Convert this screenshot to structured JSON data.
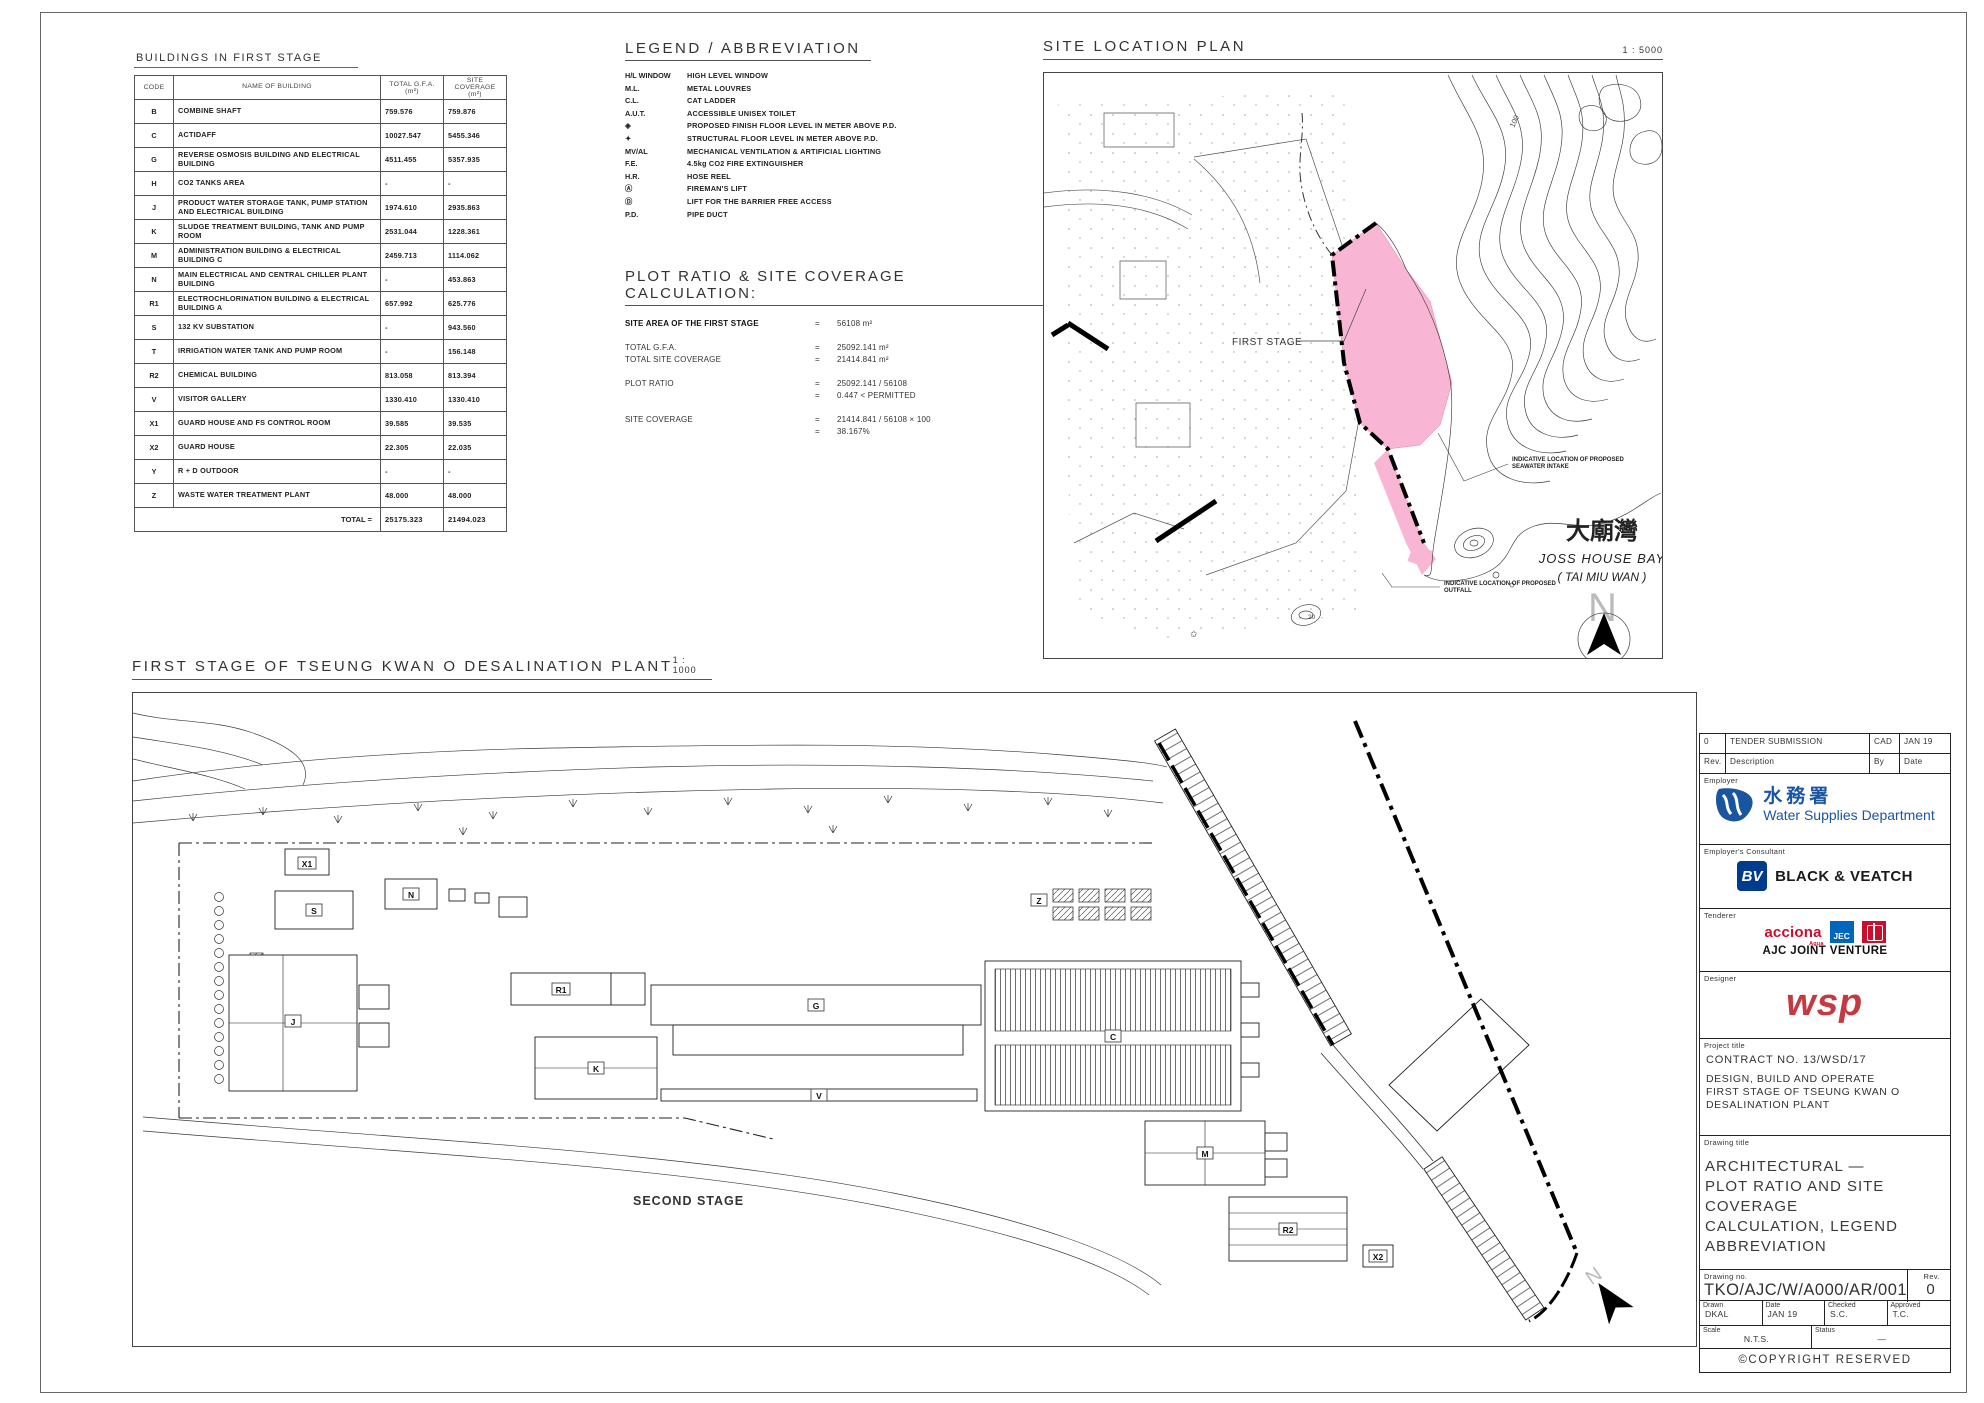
{
  "colors": {
    "pink": "#F8B6D4",
    "wsd_blue": "#1A56A0",
    "bv_navy": "#003B8E",
    "acciona_red": "#C8102E",
    "jec_blue": "#0065BD",
    "cscec_red": "#C8102E",
    "wsp_red": "#C43A42"
  },
  "buildings_table": {
    "title": "BUILDINGS IN FIRST STAGE",
    "headers": [
      "CODE",
      "NAME OF BUILDING",
      "TOTAL G.F.A. (m²)",
      "SITE COVERAGE (m²)"
    ],
    "rows": [
      {
        "code": "B",
        "name": "COMBINE SHAFT",
        "gfa": "759.576",
        "cov": "759.876"
      },
      {
        "code": "C",
        "name": "ACTIDAFF",
        "gfa": "10027.547",
        "cov": "5455.346"
      },
      {
        "code": "G",
        "name": "REVERSE OSMOSIS BUILDING AND ELECTRICAL BUILDING",
        "gfa": "4511.455",
        "cov": "5357.935"
      },
      {
        "code": "H",
        "name": "CO2 TANKS AREA",
        "gfa": "-",
        "cov": "-"
      },
      {
        "code": "J",
        "name": "PRODUCT WATER STORAGE TANK, PUMP STATION AND ELECTRICAL BUILDING",
        "gfa": "1974.610",
        "cov": "2935.863"
      },
      {
        "code": "K",
        "name": "SLUDGE TREATMENT BUILDING, TANK AND PUMP ROOM",
        "gfa": "2531.044",
        "cov": "1228.361"
      },
      {
        "code": "M",
        "name": "ADMINISTRATION BUILDING & ELECTRICAL BUILDING C",
        "gfa": "2459.713",
        "cov": "1114.062"
      },
      {
        "code": "N",
        "name": "MAIN ELECTRICAL AND CENTRAL CHILLER PLANT BUILDING",
        "gfa": "-",
        "cov": "453.863"
      },
      {
        "code": "R1",
        "name": "ELECTROCHLORINATION BUILDING & ELECTRICAL BUILDING A",
        "gfa": "657.992",
        "cov": "625.776"
      },
      {
        "code": "S",
        "name": "132 KV SUBSTATION",
        "gfa": "-",
        "cov": "943.560"
      },
      {
        "code": "T",
        "name": "IRRIGATION WATER TANK AND PUMP ROOM",
        "gfa": "-",
        "cov": "156.148"
      },
      {
        "code": "R2",
        "name": "CHEMICAL BUILDING",
        "gfa": "813.058",
        "cov": "813.394"
      },
      {
        "code": "V",
        "name": "VISITOR GALLERY",
        "gfa": "1330.410",
        "cov": "1330.410"
      },
      {
        "code": "X1",
        "name": "GUARD HOUSE AND FS CONTROL ROOM",
        "gfa": "39.585",
        "cov": "39.535"
      },
      {
        "code": "X2",
        "name": "GUARD HOUSE",
        "gfa": "22.305",
        "cov": "22.035"
      },
      {
        "code": "Y",
        "name": "R + D OUTDOOR",
        "gfa": "-",
        "cov": "-"
      },
      {
        "code": "Z",
        "name": "WASTE WATER TREATMENT PLANT",
        "gfa": "48.000",
        "cov": "48.000"
      }
    ],
    "total_label": "TOTAL =",
    "total_gfa": "25175.323",
    "total_cov": "21494.023"
  },
  "legend": {
    "title": "LEGEND / ABBREVIATION",
    "items": [
      {
        "abbr": "H/L WINDOW",
        "desc": "HIGH LEVEL WINDOW"
      },
      {
        "abbr": "M.L.",
        "desc": "METAL LOUVRES"
      },
      {
        "abbr": "C.L.",
        "desc": "CAT LADDER"
      },
      {
        "abbr": "A.U.T.",
        "desc": "ACCESSIBLE UNISEX TOILET"
      },
      {
        "abbr": "◈",
        "desc": "PROPOSED FINISH FLOOR LEVEL IN METER ABOVE P.D."
      },
      {
        "abbr": "✦",
        "desc": "STRUCTURAL FLOOR LEVEL IN METER ABOVE P.D."
      },
      {
        "abbr": "MV/AL",
        "desc": "MECHANICAL VENTILATION & ARTIFICIAL LIGHTING"
      },
      {
        "abbr": "F.E.",
        "desc": "4.5kg CO2 FIRE EXTINGUISHER"
      },
      {
        "abbr": "H.R.",
        "desc": "HOSE REEL"
      },
      {
        "abbr": "Ⓐ",
        "desc": "FIREMAN'S LIFT"
      },
      {
        "abbr": "Ⓓ",
        "desc": "LIFT FOR THE BARRIER FREE ACCESS"
      },
      {
        "abbr": "P.D.",
        "desc": "PIPE DUCT"
      }
    ]
  },
  "calc": {
    "title": "PLOT RATIO & SITE COVERAGE CALCULATION:",
    "lines": [
      {
        "label": "SITE AREA OF THE FIRST STAGE",
        "eq": "=",
        "value": "56108 m²"
      },
      {
        "label": "TOTAL G.F.A.",
        "eq": "=",
        "value": "25092.141 m²"
      },
      {
        "label": "TOTAL SITE COVERAGE",
        "eq": "=",
        "value": "21414.841 m²"
      },
      {
        "label": "PLOT RATIO",
        "eq": "=",
        "value": "25092.141 / 56108"
      },
      {
        "label": "",
        "eq": "=",
        "value": "0.447  <  PERMITTED"
      },
      {
        "label": "SITE COVERAGE",
        "eq": "=",
        "value": "21414.841 / 56108  ×  100"
      },
      {
        "label": "",
        "eq": "=",
        "value": "38.167%"
      }
    ]
  },
  "location_plan": {
    "title": "SITE LOCATION PLAN",
    "scale": "1 : 5000",
    "first_stage": "FIRST STAGE",
    "contour_100": "100",
    "contour_20": "20",
    "bay_cn": "大廟灣",
    "bay_en": "JOSS HOUSE BAY",
    "bay_en2": "( TAI MIU WAN )",
    "note_intake_1": "INDICATIVE LOCATION OF PROPOSED",
    "note_intake_2": "SEAWATER INTAKE",
    "note_outfall_1": "INDICATIVE LOCATION OF PROPOSED",
    "note_outfall_2": "OUTFALL",
    "north": "N"
  },
  "site_plan": {
    "title": "FIRST STAGE OF TSEUNG KWAN O DESALINATION PLANT",
    "scale": "1 : 1000",
    "second_stage": "SECOND STAGE",
    "north": "N",
    "labels": {
      "x1": "X1",
      "s": "S",
      "n": "N",
      "r1": "R1",
      "j": "J",
      "k": "K",
      "g": "G",
      "v": "V",
      "c": "C",
      "z": "Z",
      "m": "M",
      "r2": "R2",
      "x2": "X2"
    }
  },
  "title_block": {
    "revision": {
      "rev": "0",
      "description": "TENDER SUBMISSION",
      "by": "CAD",
      "date": "JAN 19"
    },
    "rev_headers": {
      "rev": "Rev.",
      "description": "Description",
      "by": "By",
      "date": "Date"
    },
    "employer_label": "Employer",
    "employer_cn": "水務署",
    "employer_en": "Water Supplies Department",
    "consultant_label": "Employer's Consultant",
    "consultant_logo": "BV",
    "consultant_name": "BLACK & VEATCH",
    "tenderer_label": "Tenderer",
    "acciona": "acciona",
    "acciona_sub": "Agua",
    "jec": "JEC",
    "tenderer_name": "AJC JOINT VENTURE",
    "designer_label": "Designer",
    "designer_name": "wsp",
    "project_label": "Project title",
    "project_line1": "CONTRACT NO. 13/WSD/17",
    "project_line2": "DESIGN, BUILD AND OPERATE",
    "project_line3": "FIRST STAGE OF TSEUNG KWAN O",
    "project_line4": "DESALINATION PLANT",
    "drawing_label": "Drawing title",
    "drawing_line1": "ARCHITECTURAL —",
    "drawing_line2": "PLOT RATIO AND SITE COVERAGE",
    "drawing_line3": "CALCULATION, LEGEND",
    "drawing_line4": "ABBREVIATION",
    "drawing_no_label": "Drawing no.",
    "drawing_no": "TKO/AJC/W/A000/AR/001",
    "rev_label": "Rev.",
    "rev_value": "0",
    "drawn_label": "Drawn",
    "drawn": "DKAL",
    "date_label": "Date",
    "date": "JAN 19",
    "checked_label": "Checked",
    "checked": "S.C.",
    "approved_label": "Approved",
    "approved": "T.C.",
    "scale_label": "Scale",
    "scale": "N.T.S.",
    "status_label": "Status",
    "status": "—",
    "copyright": "©COPYRIGHT RESERVED"
  }
}
